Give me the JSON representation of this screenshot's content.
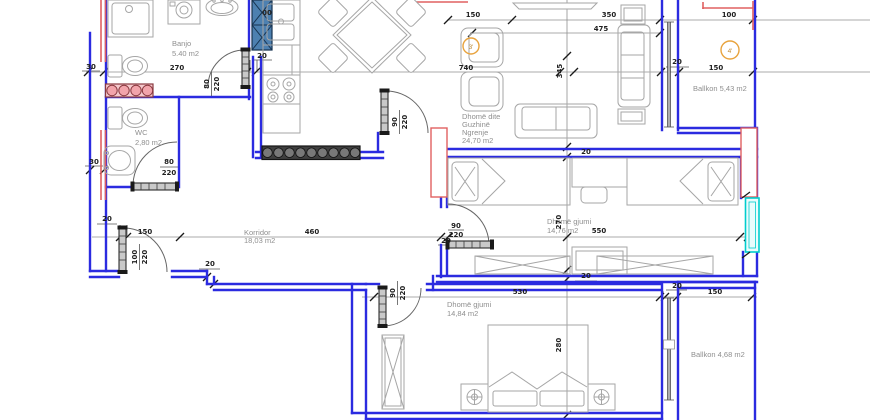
{
  "drawing": {
    "type": "architectural-floor-plan",
    "units": "cm"
  },
  "rooms": {
    "banjo": {
      "name": "Banjo",
      "area": "5.40 m2"
    },
    "wc": {
      "name": "WC",
      "area": "2,80 m2"
    },
    "living": {
      "name_l1": "Dhomë dite",
      "name_l2": "Guzhinë",
      "name_l3": "Ngrenje",
      "area": "24,70 m2"
    },
    "balkon1": {
      "label": "Ballkon 5,43 m2"
    },
    "bedroom1": {
      "name": "Dhomë gjumi",
      "area": "14,76 m2"
    },
    "korridor": {
      "name": "Korridor",
      "area": "18,03 m2"
    },
    "bedroom2": {
      "name": "Dhomë gjumi",
      "area": "14,84 m2"
    },
    "balkon2": {
      "label": "Ballkon 4,68 m2"
    }
  },
  "dims": {
    "wall_offset_top": "30",
    "wall_offset_mid": "30",
    "banjo_width": "270",
    "shaft_width": "20",
    "living_width": "740",
    "living_height": "345",
    "tv_wall": "150",
    "sofa_wall": "350",
    "living_inner": "475",
    "balkon1_top": "100",
    "balkon1_wall": "20",
    "balkon1_width": "150",
    "banjo_door_w": "80",
    "banjo_door_h": "220",
    "wc_door_w": "80",
    "wc_door_h": "220",
    "kitchen_door_w": "90",
    "kitchen_door_h": "220",
    "entry_wall": "20",
    "entry_offset": "150",
    "korridor_length": "460",
    "entry_door_w": "100",
    "entry_door_h": "220",
    "korridor_step": "20",
    "bedroom1_width": "550",
    "bedroom1_height": "270",
    "bedroom1_door_w": "90",
    "bedroom1_door_h": "220",
    "bedroom1_door_wall": "20",
    "bedroom1_wall_n": "20",
    "bedroom1_wall_s": "20",
    "bedroom2_width": "530",
    "bedroom2_height": "280",
    "bedroom2_door_w": "90",
    "bedroom2_door_h": "220",
    "balkon2_wall": "20",
    "balkon2_width": "150",
    "top_fragment": "00"
  },
  "annotations": {
    "circle3": "3'",
    "circle4": "4'"
  },
  "colors": {
    "wall_blue": "#2b2be0",
    "highlight_red": "#e06060",
    "cyan_window": "#00cdcd",
    "column_blue": "#4d80b0",
    "radiator_pink": "#f5c9cd",
    "radiator_dark": "#3f3f3f",
    "accent_orange": "#e8a33d",
    "furniture_gray": "#a6a6a6"
  }
}
